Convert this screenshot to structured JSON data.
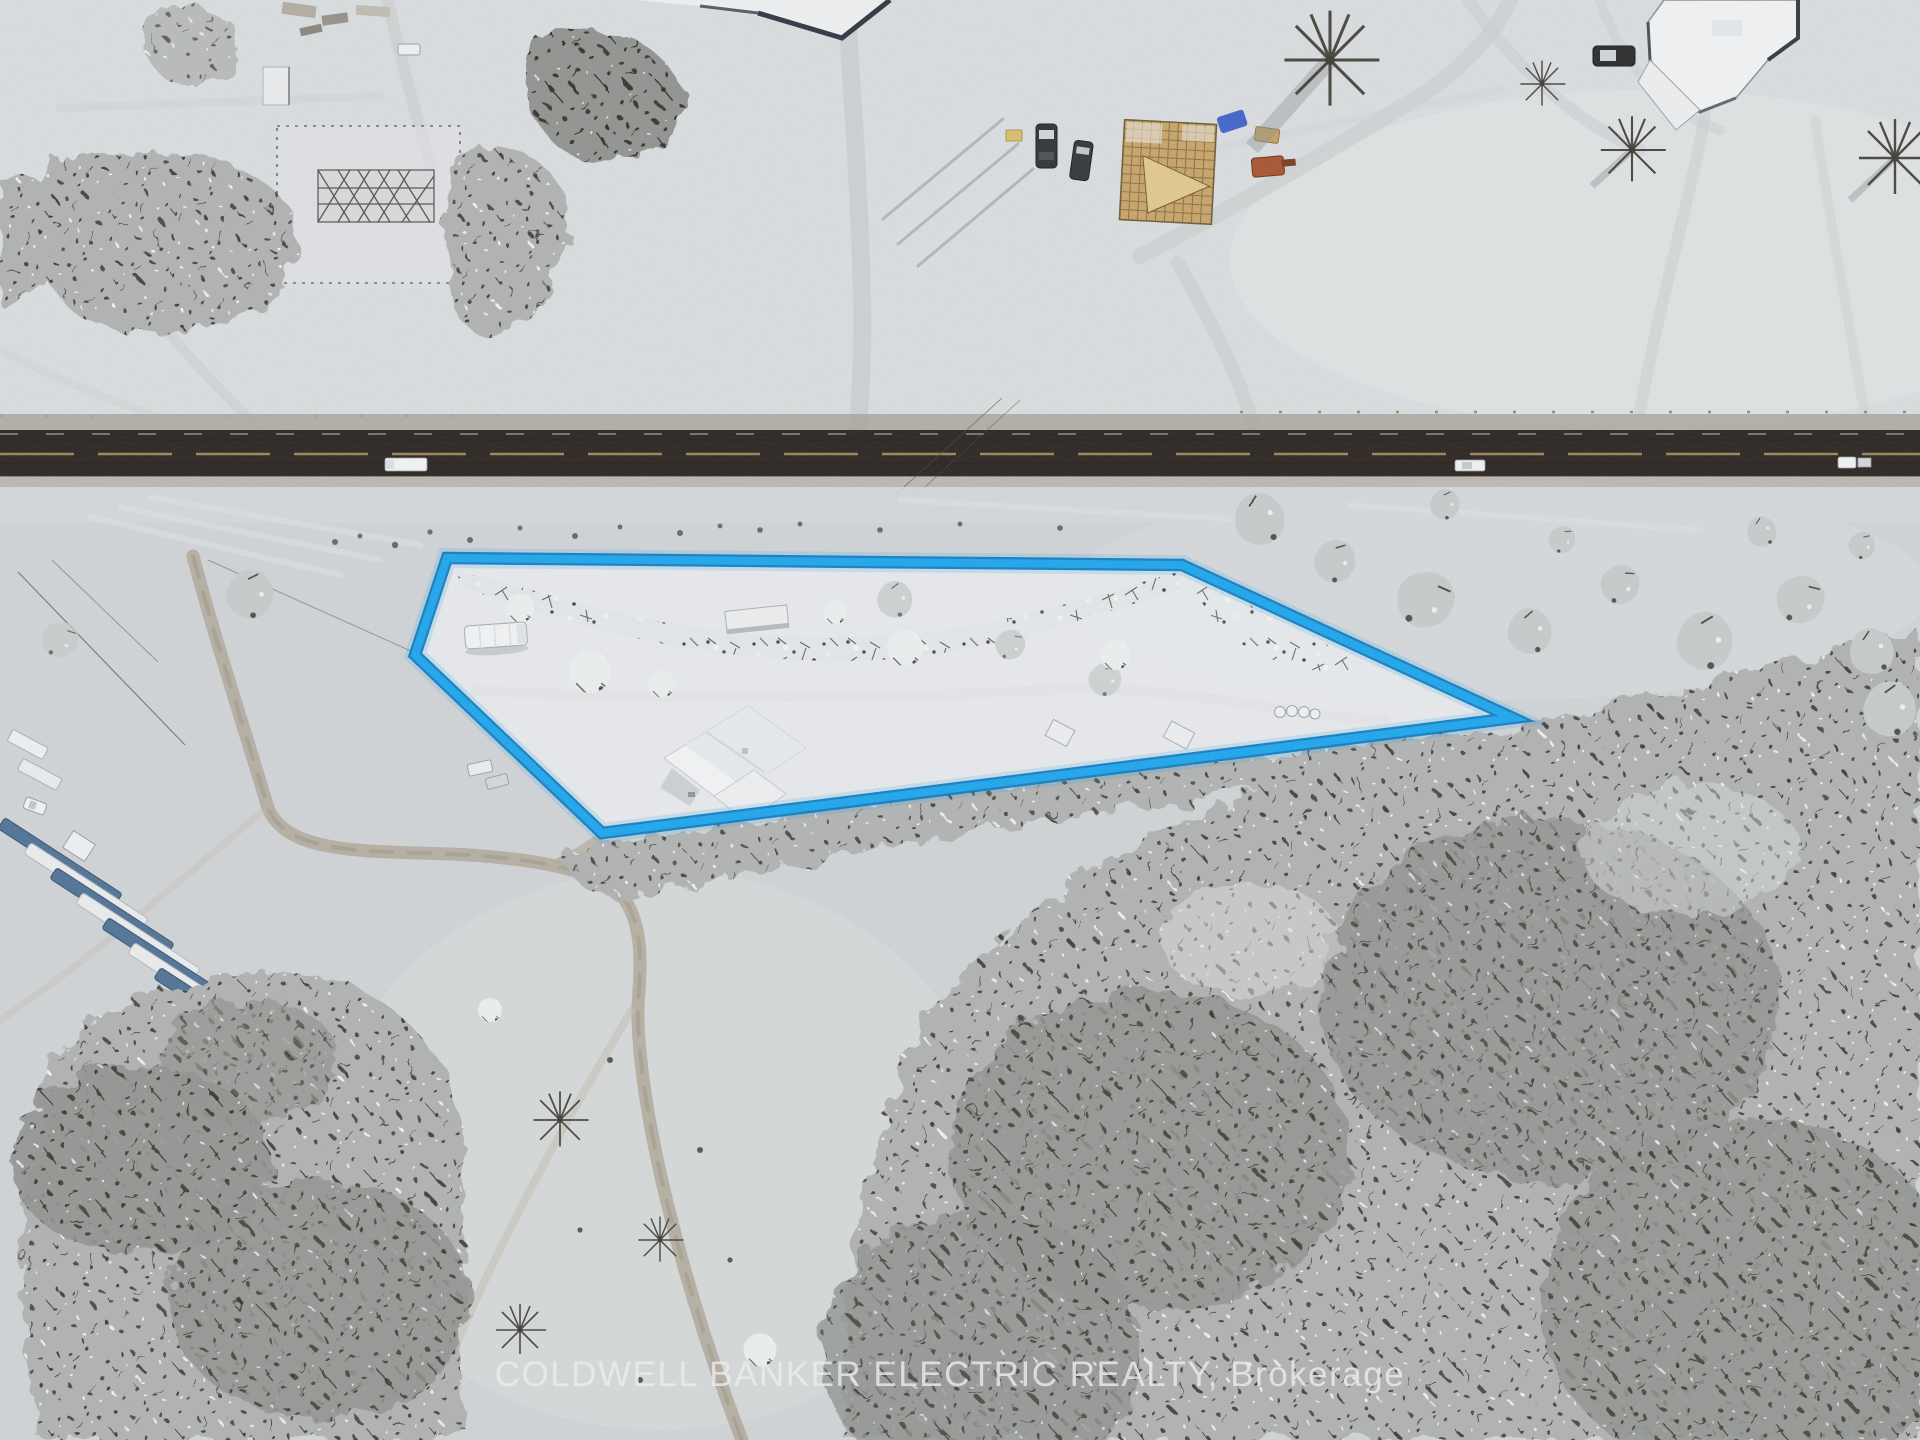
{
  "scene": {
    "kind": "aerial-drone-winter-real-estate-photo",
    "watermark_text": "COLDWELL BANKER ELECTRIC REALTY, Brokerage"
  },
  "property_outline": {
    "points": "447,558 1182,565 1513,718 602,833 415,655",
    "core_color": "#1ba6ef",
    "edge_color": "#0b79c0",
    "glow_color": "#1ba6ef",
    "lot_fill": "#eceef0"
  },
  "road": {
    "asphalt_color": "#28221d",
    "center_line_color": "#a8905f"
  },
  "palette": {
    "snow_base": "#d4d7da",
    "snow_upper_field": "#dcdfe1",
    "snow_bright": "#e9ecee",
    "verge_gravel": "#a59e93",
    "forest_mid": "#b0b3b1",
    "forest_dark": "#90938f",
    "lumber_tarp_blue": "#4e7296",
    "construction_wood": "#c9a467",
    "machine_orange": "#a8522e",
    "tarp_blue": "#2e55c6"
  }
}
